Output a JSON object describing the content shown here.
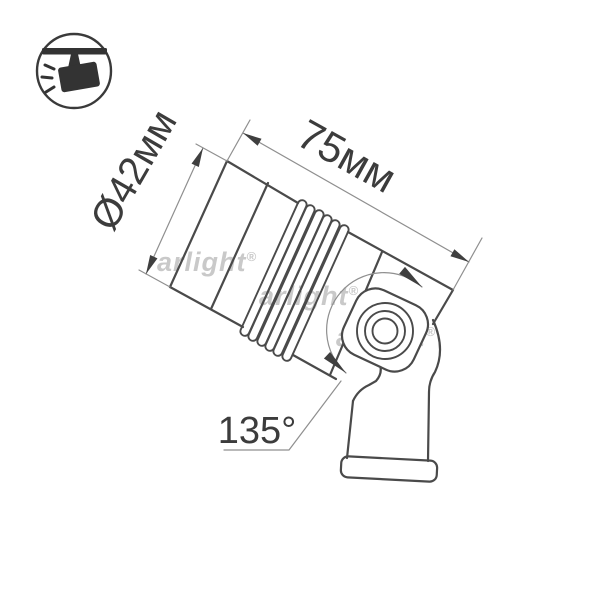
{
  "diagram": {
    "kind": "product-dimension-drawing",
    "subject": "tiltable spotlight luminaire on mounting bracket",
    "labels": {
      "diameter": "Ø42мм",
      "length": "75мм",
      "angle": "135°"
    },
    "watermark": {
      "text": "arlight",
      "reg": "®",
      "color": "#c9c9c9",
      "instances": 3
    },
    "icon": {
      "name": "track-spotlight-icon"
    },
    "colors": {
      "background": "#ffffff",
      "outline": "#4a4a4a",
      "dimension_lines": "#8f8f8f",
      "dimension_text": "#3c3c3c",
      "icon": "#333333"
    },
    "features": {
      "heatsink_fins": 6,
      "pivot_rings": 3
    }
  }
}
